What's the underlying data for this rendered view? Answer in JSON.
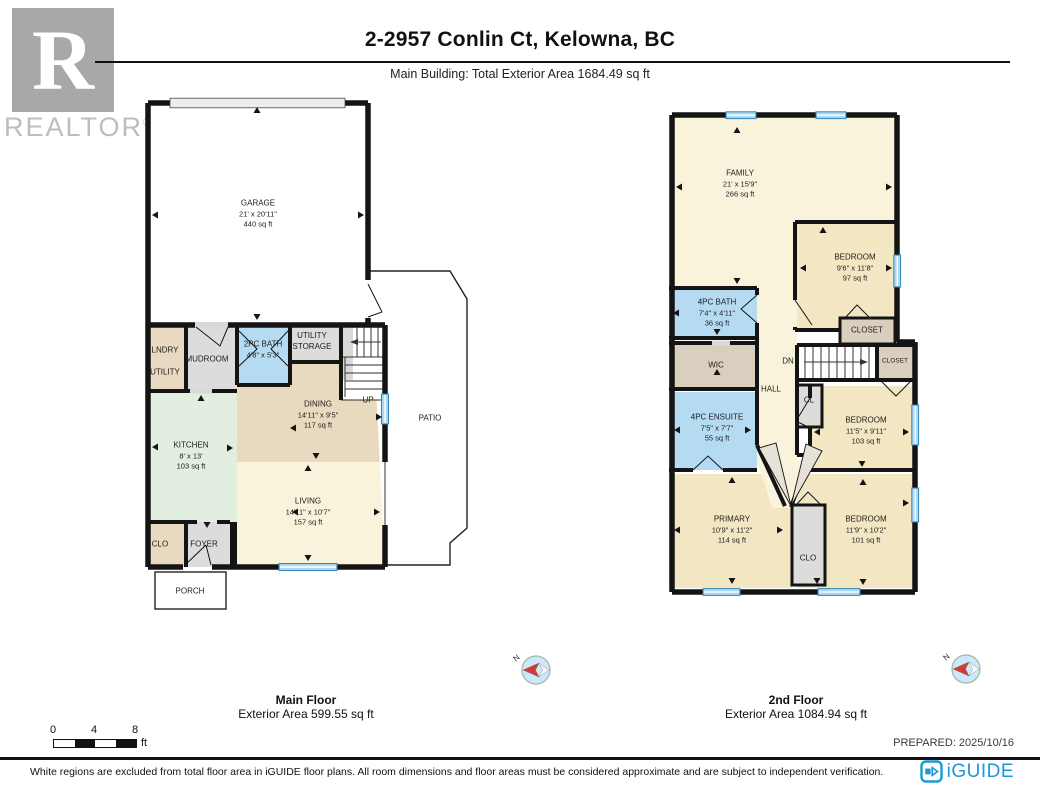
{
  "header": {
    "title": "2-2957 Conlin Ct, Kelowna, BC",
    "subtitle": "Main Building: Total Exterior Area 1684.49 sq ft"
  },
  "watermark": {
    "r": "R",
    "name": "REALTOR",
    "reg": "®"
  },
  "floors": {
    "main": {
      "caption": "Main Floor",
      "area_caption": "Exterior Area 599.55 sq ft",
      "rooms": {
        "garage": {
          "name": "GARAGE",
          "dims": "21' x 20'11\"",
          "area": "440 sq ft"
        },
        "lndry": {
          "line1": "LNDRY",
          "line2": "UTILITY"
        },
        "mudroom": {
          "name": "MUDROOM"
        },
        "bath": {
          "name": "2PC BATH",
          "dims": "4'8\" x 5'3\""
        },
        "storage": {
          "line1": "UTILITY",
          "line2": "STORAGE"
        },
        "stairs": {
          "name": "UP"
        },
        "dining": {
          "name": "DINING",
          "dims": "14'11\" x 9'5\"",
          "area": "117 sq ft"
        },
        "kitchen": {
          "name": "KITCHEN",
          "dims": "8' x 13'",
          "area": "103 sq ft"
        },
        "living": {
          "name": "LIVING",
          "dims": "14'11\" x 10'7\"",
          "area": "157 sq ft"
        },
        "clo": {
          "name": "CLO"
        },
        "foyer": {
          "name": "FOYER"
        },
        "porch": {
          "name": "PORCH"
        },
        "patio": {
          "name": "PATIO"
        }
      }
    },
    "second": {
      "caption": "2nd Floor",
      "area_caption": "Exterior Area 1084.94 sq ft",
      "rooms": {
        "family": {
          "name": "FAMILY",
          "dims": "21' x 15'9\"",
          "area": "266 sq ft"
        },
        "bedroom1": {
          "name": "BEDROOM",
          "dims": "9'6\" x 11'8\"",
          "area": "97 sq ft"
        },
        "bath": {
          "name": "4PC BATH",
          "dims": "7'4\" x 4'11\"",
          "area": "36 sq ft"
        },
        "closet1": {
          "name": "CLOSET"
        },
        "wic": {
          "name": "WIC"
        },
        "stairs": {
          "name": "DN"
        },
        "closet2": {
          "name": "CLOSET"
        },
        "hall": {
          "name": "HALL"
        },
        "cl": {
          "name": "CL"
        },
        "ensuite": {
          "name": "4PC ENSUITE",
          "dims": "7'5\" x 7'7\"",
          "area": "55 sq ft"
        },
        "bedroom2": {
          "name": "BEDROOM",
          "dims": "11'5\" x 9'11\"",
          "area": "103 sq ft"
        },
        "primary": {
          "name": "PRIMARY",
          "dims": "10'9\" x 11'2\"",
          "area": "114 sq ft"
        },
        "clo": {
          "name": "CLO"
        },
        "bedroom3": {
          "name": "BEDROOM",
          "dims": "11'9\" x 10'2\"",
          "area": "101 sq ft"
        }
      }
    }
  },
  "compass": {
    "north": "N"
  },
  "scale_bar": {
    "tick0": "0",
    "tick1": "4",
    "tick2": "8",
    "unit": "ft"
  },
  "prepared": "PREPARED: 2025/10/16",
  "footer": {
    "disclaimer": "White regions are excluded from total floor area in iGUIDE floor plans. All room dimensions and floor areas must be considered approximate and are subject to independent verification.",
    "brand": "iGUIDE"
  },
  "colors": {
    "wall": "#141414",
    "window": "#2f86ba",
    "window_fill": "#aed6ee",
    "bath_blue": "#b5dbf3",
    "cream": "#f9f3dc",
    "bedroom_tan": "#f3e6c2",
    "dining_tan": "#e9d9bf",
    "kitchen_green": "#e2eedf",
    "gray_room": "#dcdcda",
    "closet_tan": "#dacfbe",
    "iguide_blue": "#1b98d5",
    "compass_red": "#d23b33"
  }
}
